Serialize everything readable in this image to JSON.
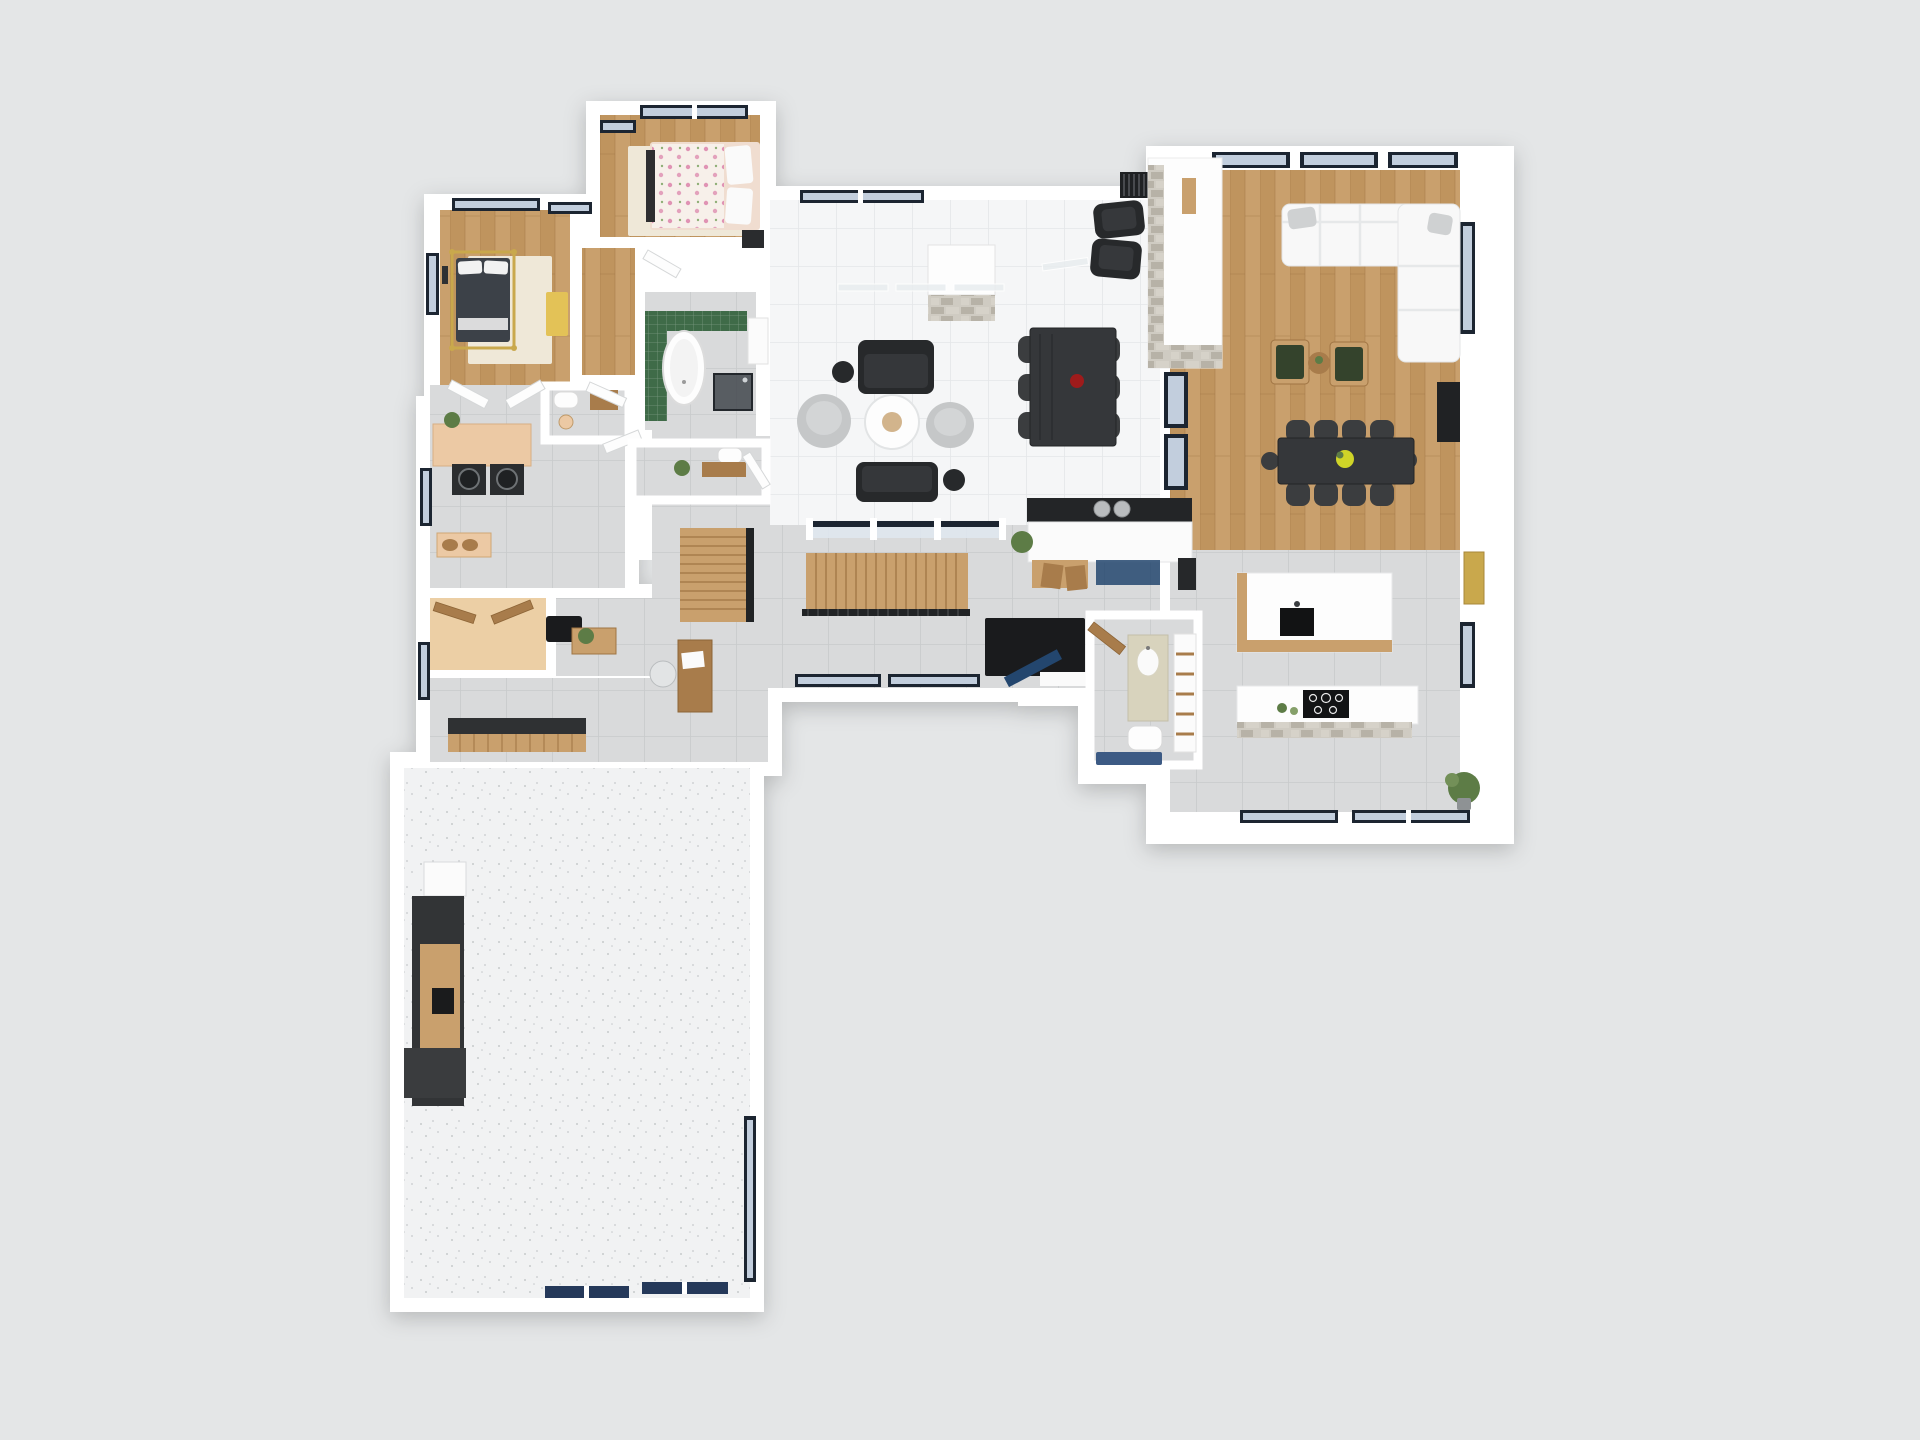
{
  "scene": {
    "type": "3d-floorplan-render",
    "view": "top-down-dollhouse",
    "floors_shown": 1,
    "rooms": [
      {
        "id": "bedroom-1",
        "floor": "wood",
        "items": [
          "gold-canopy-bed",
          "cream-area-rug",
          "yellow-accent-bench",
          "wall-art",
          "windows"
        ]
      },
      {
        "id": "bedroom-2",
        "floor": "wood",
        "items": [
          "bed-floral-duvet",
          "cream-area-rug",
          "dark-nightstand",
          "windows"
        ]
      },
      {
        "id": "ensuite-bathroom",
        "floor": "gray-tile",
        "items": [
          "green-tile-surround",
          "freestanding-oval-tub",
          "walk-in-shower",
          "white-vanity"
        ]
      },
      {
        "id": "wc",
        "floor": "gray-tile",
        "items": [
          "toilet",
          "wood-cabinet",
          "basket"
        ]
      },
      {
        "id": "laundry-room",
        "floor": "gray-tile",
        "items": [
          "tan-counter",
          "washer",
          "dryer",
          "plant",
          "window"
        ]
      },
      {
        "id": "hallway",
        "floor": "wood",
        "items": [
          "open-white-doors",
          "console-with-baskets"
        ]
      },
      {
        "id": "walk-in-closet",
        "floor": "tan-carpet",
        "items": [
          "open-wood-bifold-doors"
        ]
      },
      {
        "id": "mudroom",
        "floor": "gray-tile",
        "items": [
          "built-in-bench",
          "door-mat",
          "console-table",
          "plant",
          "wood-desk",
          "office-chair",
          "window"
        ]
      },
      {
        "id": "garage",
        "floor": "speckled-concrete",
        "items": [
          "refrigerator",
          "dark-workbench-cabinets",
          "wood-countertop",
          "garage-doors",
          "side-window"
        ]
      },
      {
        "id": "living-room",
        "floor": "white-tile",
        "items": [
          "fireplace-stone-base",
          "black-loveseat-x2",
          "gray-pouf-x2",
          "round-coffee-table",
          "black-side-table-x2",
          "black-armchair-x2",
          "slat-bench",
          "glass-partitions"
        ]
      },
      {
        "id": "dining-area",
        "floor": "white-tile",
        "items": [
          "black-table",
          "black-chairs-x6",
          "red-vase-centerpiece"
        ]
      },
      {
        "id": "entry-hall",
        "floor": "gray-tile",
        "items": [
          "l-shaped-wood-staircase",
          "black-stair-railing",
          "navy-front-door",
          "black-door-mat",
          "bar-cabinet",
          "steel-canisters",
          "blue-glass-doors",
          "wood-stools",
          "plant",
          "glass-interior-wall"
        ]
      },
      {
        "id": "powder-room",
        "floor": "gray-tile",
        "items": [
          "toilet",
          "wood-vanity",
          "plant",
          "open-door"
        ]
      },
      {
        "id": "great-room",
        "floor": "wood",
        "items": [
          "white-sectional-sofa",
          "gray-pillows",
          "green-armchair-x2",
          "round-wood-side-table",
          "long-black-dining-table",
          "black-chairs-x10",
          "yellow-flower-centerpiece",
          "double-sided-fireplace",
          "black-media-console",
          "gold-wall-art",
          "windows"
        ]
      },
      {
        "id": "kitchen",
        "floor": "gray-tile",
        "items": [
          "island-white-top-wood-base",
          "black-sink",
          "cooktop-counter",
          "stone-clad-front",
          "small-plants",
          "tall-potted-plant",
          "windows"
        ]
      },
      {
        "id": "bathroom-2",
        "floor": "gray-tile",
        "items": [
          "cream-vanity",
          "toilet",
          "blue-mat",
          "linen-shelves",
          "open-wood-door"
        ]
      }
    ]
  },
  "palette": {
    "background": "#e4e6e7",
    "wall": "#ffffff",
    "wood": "#c9a06d",
    "woodAlt": "#bf945e",
    "woodDark": "#a87c4b",
    "tileWhite": "#f5f6f7",
    "tileWhiteLine": "#e4e6e8",
    "tileGray": "#d9dadb",
    "tileGrayLine": "#c8cacb",
    "carpet": "#eccfa5",
    "counterTan": "#ecc9a4",
    "garageFloor": "#f1f2f3",
    "speckle": "#c7cacc",
    "windowFrame": "#1c2531",
    "windowGlass": "#c2cedd",
    "glassLight": "#dfe7ee",
    "doorNavy": "#23466e",
    "garageDoorNavy": "#25395a",
    "furnitureBlack": "#27292b",
    "charcoal": "#3b3d3f",
    "sofaWhite": "#f8f8f8",
    "poufGray": "#c5c7c8",
    "greenCushion": "#34432c",
    "greenTile": "#3f6b48",
    "tub": "#fdfdfd",
    "stoneA": "#cfcbc2",
    "stoneB": "#b7b2a7",
    "stoneC": "#d6d2c9",
    "gold": "#c9a84c",
    "yellowBench": "#e3c257",
    "red": "#9e1b1b",
    "plantGreen": "#5d7c46",
    "cream": "#efe8d8",
    "blush": "#f0ddd0",
    "floralBase": "#f7f0ea",
    "floralPink": "#e093b4",
    "vanityCream": "#d8d3bd",
    "matBlue": "#3c5a84",
    "blackMat": "#1a1b1d",
    "steel": "#b9bcbe"
  }
}
